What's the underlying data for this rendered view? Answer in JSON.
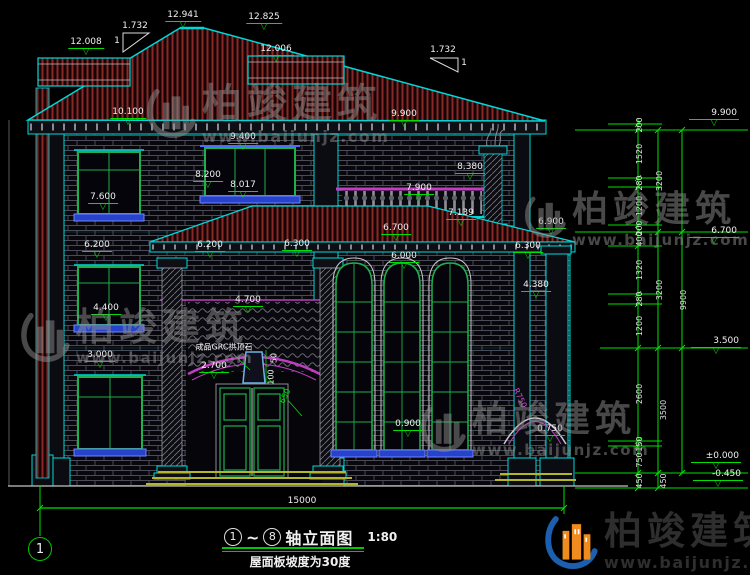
{
  "title_block": {
    "axis_start": "1",
    "tilde": "~",
    "axis_end": "8",
    "title": "轴立面图",
    "scale": "1:80",
    "subtitle": "屋面板坡度为30度"
  },
  "axis_bubble": {
    "label": "1"
  },
  "brand": {
    "name": "柏竣建筑",
    "url": "www.baijunjz.com"
  },
  "colors": {
    "outline_cyan": "#00d8d8",
    "dim_green": "#00e000",
    "roof_hatch_red": "#8a2828",
    "trim_magenta": "#c03ec0",
    "sill_blue": "#2743cc",
    "brand_blue": "#1c5fae",
    "brand_orange": "#f08c1e"
  },
  "levels": [
    {
      "text": "12.008",
      "x": 86,
      "y": 38
    },
    {
      "text": "12.941",
      "x": 183,
      "y": 11
    },
    {
      "text": "12.825",
      "x": 264,
      "y": 13
    },
    {
      "text": "12.006",
      "x": 276,
      "y": 45
    },
    {
      "text": "10.100",
      "x": 128,
      "y": 108
    },
    {
      "text": "9.400",
      "x": 243,
      "y": 133
    },
    {
      "text": "9.900",
      "x": 404,
      "y": 110
    },
    {
      "text": "8.200",
      "x": 208,
      "y": 171
    },
    {
      "text": "8.017",
      "x": 243,
      "y": 181
    },
    {
      "text": "8.380",
      "x": 470,
      "y": 163
    },
    {
      "text": "7.900",
      "x": 419,
      "y": 184
    },
    {
      "text": "7.600",
      "x": 103,
      "y": 193
    },
    {
      "text": "7.139",
      "x": 461,
      "y": 209
    },
    {
      "text": "6.700",
      "x": 396,
      "y": 224
    },
    {
      "text": "6.900",
      "x": 551,
      "y": 218
    },
    {
      "text": "6.200",
      "x": 97,
      "y": 241
    },
    {
      "text": "6.200",
      "x": 210,
      "y": 241
    },
    {
      "text": "6.300",
      "x": 297,
      "y": 240
    },
    {
      "text": "6.000",
      "x": 404,
      "y": 252
    },
    {
      "text": "6.300",
      "x": 528,
      "y": 242
    },
    {
      "text": "4.400",
      "x": 106,
      "y": 304
    },
    {
      "text": "4.700",
      "x": 248,
      "y": 296
    },
    {
      "text": "4.380",
      "x": 536,
      "y": 281
    },
    {
      "text": "3.000",
      "x": 100,
      "y": 351
    },
    {
      "text": "2.700",
      "x": 214,
      "y": 362
    },
    {
      "text": "0.900",
      "x": 408,
      "y": 420
    },
    {
      "text": "0.750",
      "x": 550,
      "y": 425
    },
    {
      "text": "9.900",
      "x": 714,
      "y": 109,
      "cls": "rc"
    },
    {
      "text": "6.700",
      "x": 714,
      "y": 227,
      "cls": "rc"
    },
    {
      "text": "3.500",
      "x": 716,
      "y": 337,
      "cls": "rc"
    },
    {
      "text": "±0.000",
      "x": 716,
      "y": 452,
      "cls": "rc"
    },
    {
      "text": "-0.450",
      "x": 718,
      "y": 470,
      "cls": "rc"
    }
  ],
  "vdims": [
    {
      "text": "200",
      "x": 640,
      "y": 125
    },
    {
      "text": "1520",
      "x": 640,
      "y": 154
    },
    {
      "text": "280",
      "x": 640,
      "y": 183
    },
    {
      "text": "1200",
      "x": 640,
      "y": 206
    },
    {
      "text": "200",
      "x": 640,
      "y": 228
    },
    {
      "text": "400",
      "x": 640,
      "y": 239
    },
    {
      "text": "1320",
      "x": 640,
      "y": 270
    },
    {
      "text": "280",
      "x": 640,
      "y": 299
    },
    {
      "text": "1200",
      "x": 640,
      "y": 326
    },
    {
      "text": "2600",
      "x": 640,
      "y": 394
    },
    {
      "text": "150",
      "x": 640,
      "y": 444
    },
    {
      "text": "750",
      "x": 640,
      "y": 460
    },
    {
      "text": "450",
      "x": 640,
      "y": 481
    },
    {
      "text": "450",
      "x": 664,
      "y": 481
    },
    {
      "text": "3200",
      "x": 660,
      "y": 181
    },
    {
      "text": "3200",
      "x": 660,
      "y": 290
    },
    {
      "text": "3500",
      "x": 664,
      "y": 410
    },
    {
      "text": "9900",
      "x": 684,
      "y": 300
    }
  ],
  "notes": [
    {
      "text": "成品GRC拱顶石",
      "x": 224,
      "y": 347,
      "cls": "sm"
    },
    {
      "text": "1.732",
      "x": 135,
      "y": 26
    },
    {
      "text": "1",
      "x": 117,
      "y": 41
    },
    {
      "text": "1.732",
      "x": 443,
      "y": 50
    },
    {
      "text": "1",
      "x": 464,
      "y": 63
    },
    {
      "text": "50",
      "x": 274,
      "y": 358,
      "rot": -90,
      "cls": "sm"
    },
    {
      "text": "100",
      "x": 271,
      "y": 377,
      "rot": -90,
      "cls": "sm"
    },
    {
      "text": "650",
      "x": 285,
      "y": 396,
      "rot": -64,
      "cls": "sm grn"
    },
    {
      "text": "R750",
      "x": 520,
      "y": 398,
      "rot": 64,
      "cls": "sm mag"
    }
  ],
  "hdims": [
    {
      "text": "15000",
      "x": 302,
      "y": 496
    }
  ]
}
